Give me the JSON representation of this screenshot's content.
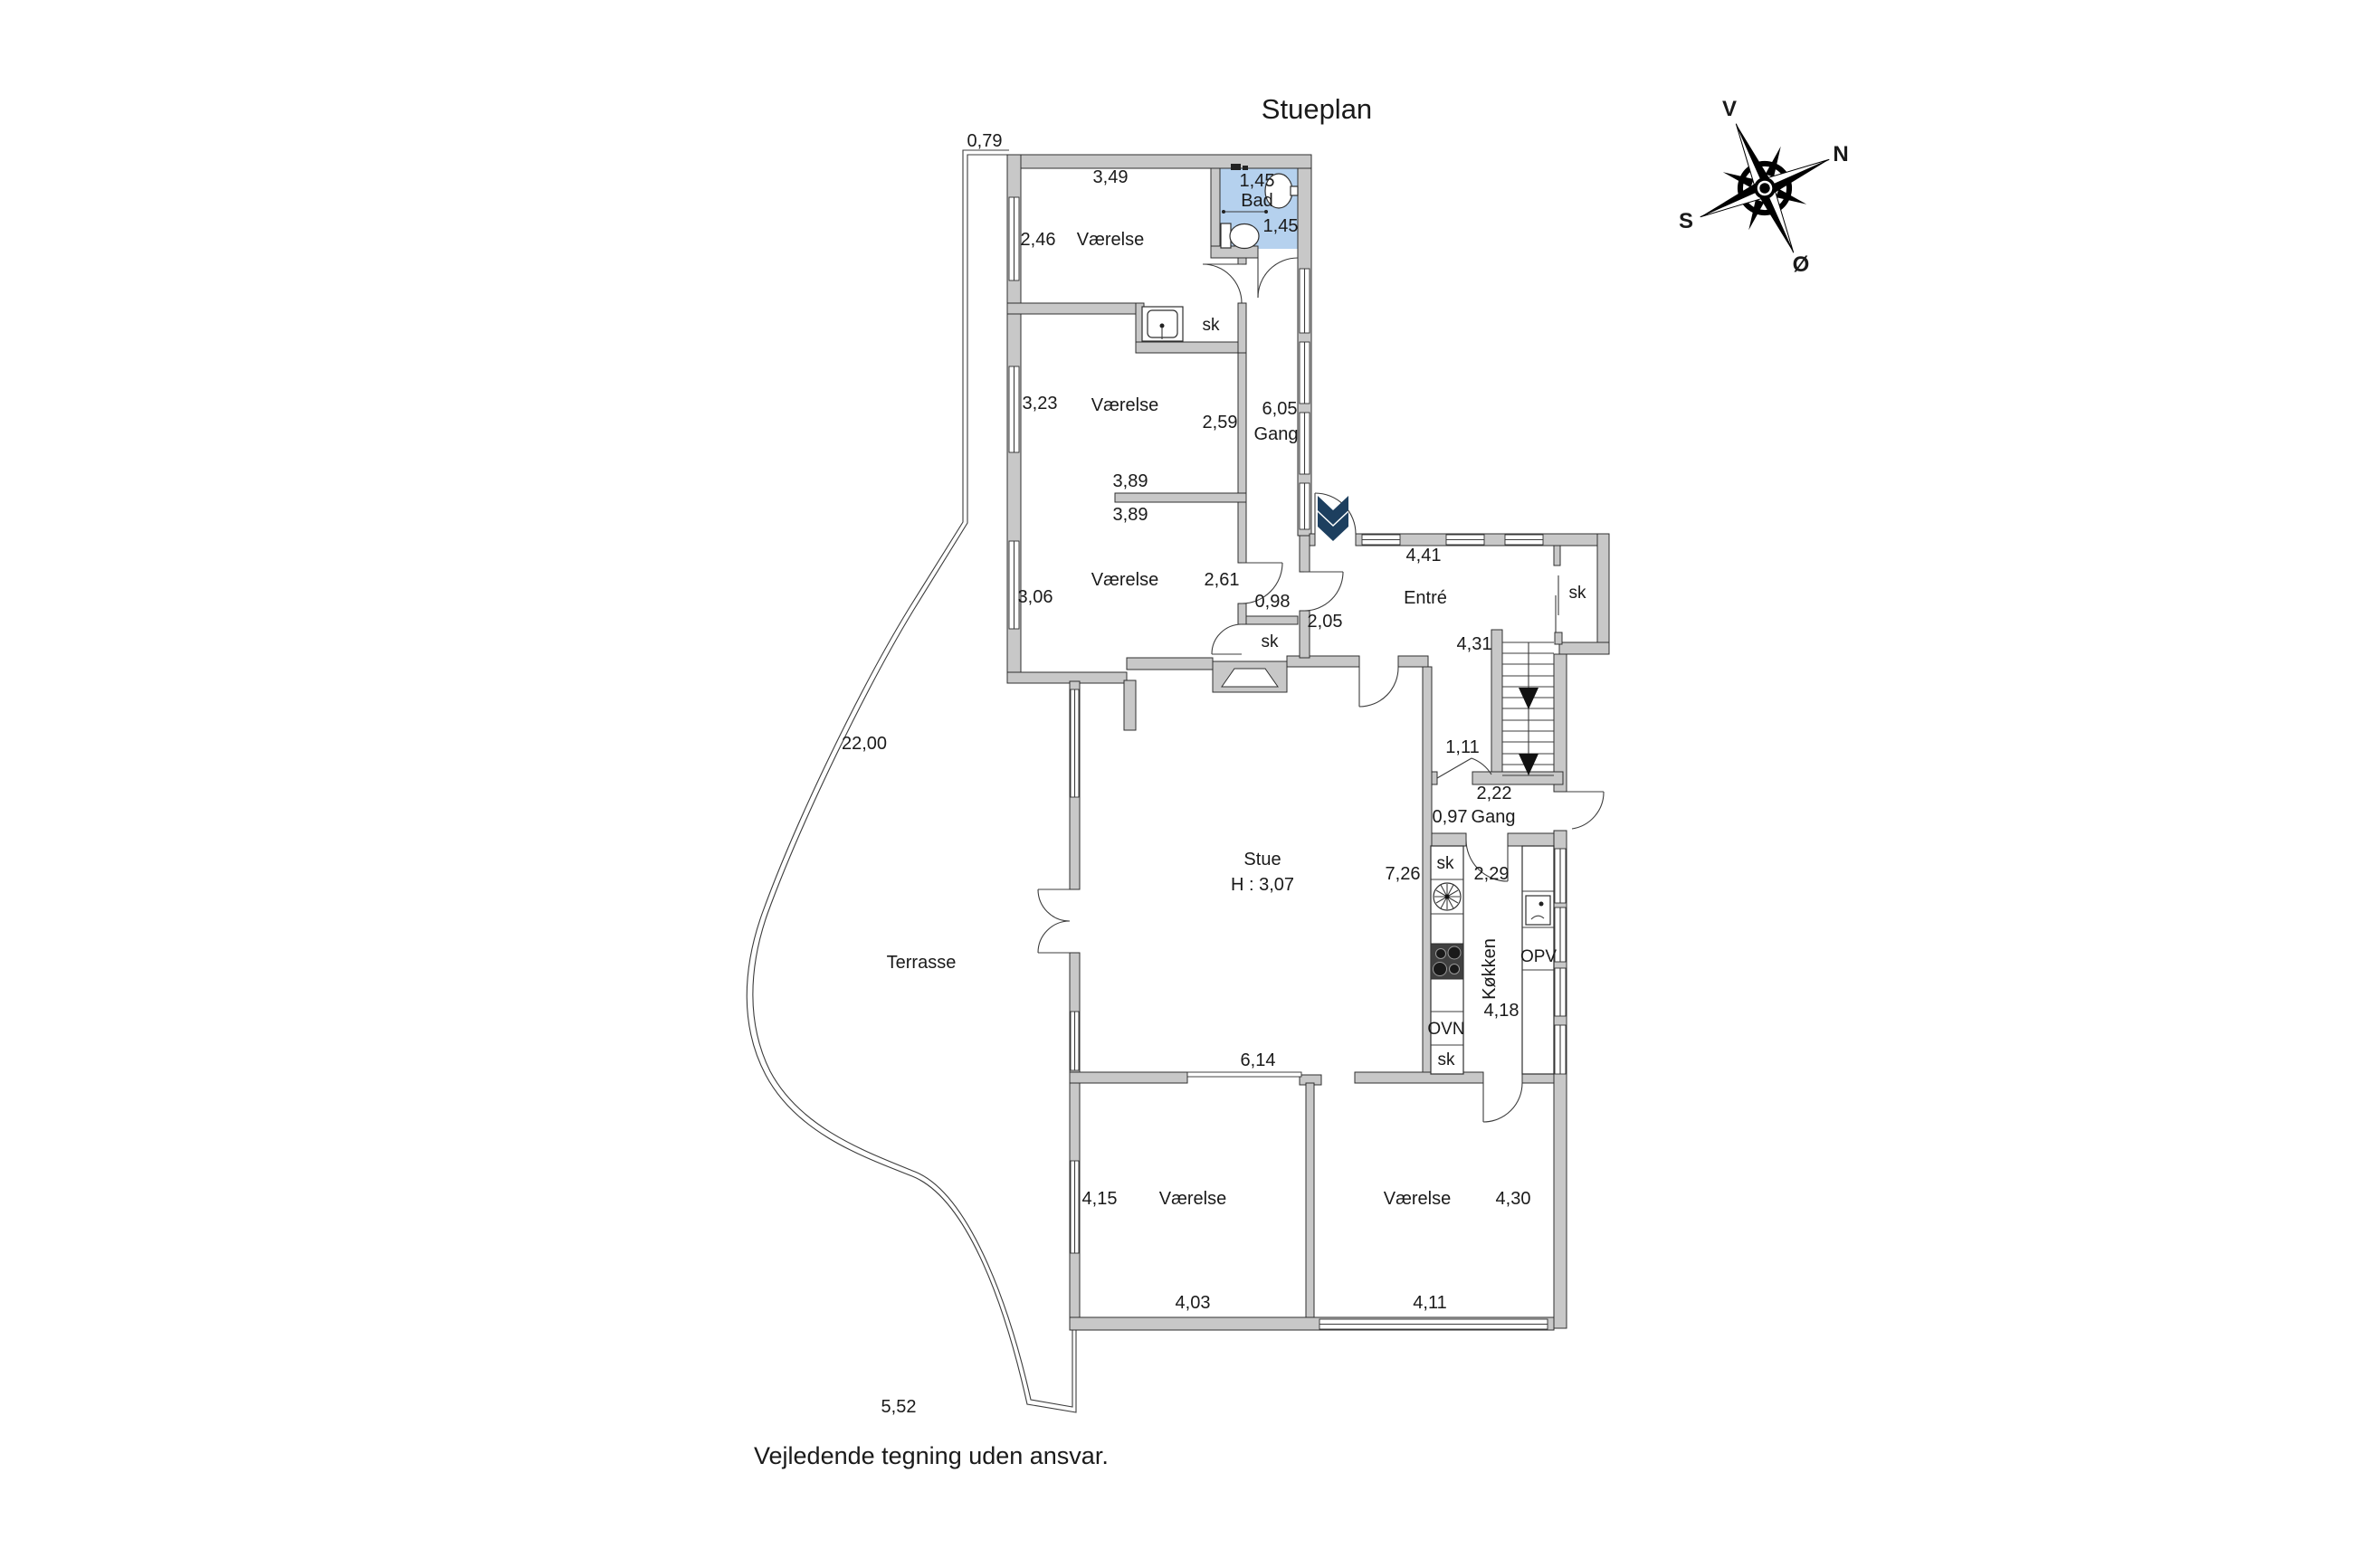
{
  "title": "Stueplan",
  "footer": {
    "disclaimer": "Vejledende tegning uden ansvar."
  },
  "compass": {
    "west": "V",
    "north": "N",
    "south": "S",
    "east": "Ø"
  },
  "colors": {
    "wall_fill": "#c8c8c8",
    "wall_stroke": "#2f2f2f",
    "bath_fill": "#b5d1ee",
    "entry_arrow": "#1d3f5f",
    "line": "#3c3c3c"
  },
  "plan": {
    "bath": {
      "name": "Bad",
      "dim_width": "1,45",
      "dim_depth": "1,45"
    },
    "bedroom_nw": {
      "name": "Værelse",
      "dim_top": "3,49",
      "dim_left": "2,46"
    },
    "closet_niche": {
      "label": "sk"
    },
    "bedroom_mid": {
      "name": "Værelse",
      "dim_left": "3,23",
      "dim_right": "2,59"
    },
    "divider_dims": {
      "upper": "3,89",
      "lower": "3,89"
    },
    "bedroom_sw": {
      "name": "Værelse",
      "dim_left": "3,06",
      "dim_right": "2,61"
    },
    "hall_upper": {
      "name": "Gang",
      "dim": "6,05"
    },
    "closet_hall": {
      "label": "sk",
      "dim": "0,98"
    },
    "entre": {
      "name": "Entré",
      "dim_top": "4,41",
      "dim_left": "2,05",
      "closet": "sk"
    },
    "stairs": {
      "dim": "4,31"
    },
    "hall_lower": {
      "name": "Gang",
      "dim_width": "0,97",
      "dim_length": "2,22",
      "dim_door": "1,11"
    },
    "stue": {
      "name": "Stue",
      "ceiling_height": "H : 3,07",
      "dim_bottom": "6,14",
      "dim_right": "7,26"
    },
    "kitchen": {
      "name": "Køkken",
      "dim_length": "4,18",
      "dim_width": "2,29",
      "closet_top": "sk",
      "closet_bottom": "sk",
      "oven": "OVN",
      "dishwasher": "OPV"
    },
    "terrace": {
      "name": "Terrasse",
      "dim_side": "22,00",
      "dim_bottom": "5,52",
      "dim_top": "0,79"
    },
    "bedroom_s1": {
      "name": "Værelse",
      "dim_left": "4,15",
      "dim_bottom": "4,03"
    },
    "bedroom_s2": {
      "name": "Værelse",
      "dim_right": "4,30",
      "dim_bottom": "4,11"
    }
  }
}
